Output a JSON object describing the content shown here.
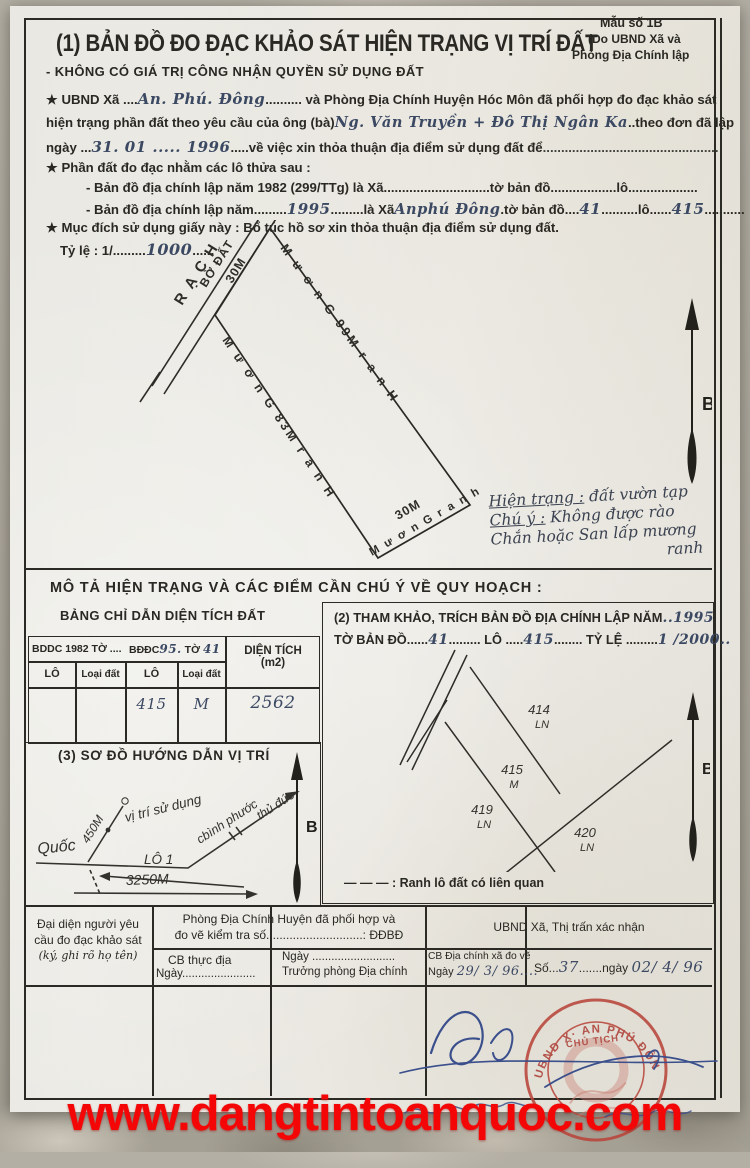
{
  "watermark": "www.dangtintoanquoc.com",
  "header": {
    "title": "(1) BẢN ĐỒ ĐO ĐẠC KHẢO SÁT HIỆN TRẠNG VỊ TRÍ ĐẤT",
    "subtitle": "- KHÔNG CÓ GIÁ TRỊ CÔNG NHẬN QUYỀN SỬ DỤNG ĐẤT",
    "form_note_1": "Mẫu số 1B",
    "form_note_2": "(Do UBND Xã và",
    "form_note_3": "Phòng Địa Chính lập"
  },
  "intro": {
    "line1_pre": "★  UBND Xã ....",
    "line1_hw": "An. Phú. Đông",
    "line1_post": ".......... và Phòng Địa Chính Huyện Hóc Môn đã phối hợp đo đạc khảo sát",
    "line2_pre": "hiện trạng phần đất theo yêu cầu của ông (bà)",
    "line2_hw": "Ng. Văn Truyền + Đô Thị Ngân Ka",
    "line2_post": "..theo đơn đã lập",
    "line3_pre": "ngày ...",
    "line3_hw": "31. 01 ..... 1996",
    "line3_post": ".....về việc xin thỏa thuận địa điểm sử dụng đất để",
    "line3_dots": "................................................",
    "line4": "★  Phần đất đo đạc nhằm các lô thửa sau :",
    "line5": "- Bản đồ địa chính lập năm 1982 (299/TTg) là Xã.............................tờ bản đồ..................lô...................",
    "line6_pre": "- Bản đồ địa chính lập năm.........",
    "line6_hw_year": "1995",
    "line6_d1": ".........là Xã",
    "line6_hw_commune": "Anphú Đông",
    "line6_d2": ".tờ bản đồ....",
    "line6_hw_sheet": "41",
    "line6_d3": "..........lô......",
    "line6_hw_lot": "415",
    "line6_d4": "...........",
    "line7": "★  Mục đích sử dụng giấy này : Bổ túc hồ sơ xin thỏa thuận địa điểm sử dụng đất.",
    "line8_pre": "Tỷ lệ : 1/.........",
    "line8_hw": "1000",
    "line8_post": "......"
  },
  "map1": {
    "canal_label_1": "R Ạ C H",
    "canal_label_2": "BỜ  ĐẤT",
    "edge_top": "30M",
    "edge_right": "M ư ơ n G     99M     r a n H",
    "edge_left": "M ư ơ n G    83M    r a n H",
    "edge_bottom_num": "30M",
    "edge_bottom_text": "M ư ơ n G   r a n h",
    "north_label": "B",
    "note_line1": "Hiện trạng :",
    "note_line1b": "đất vườn tạp",
    "note_line2": "Chú ý :",
    "note_line2b": "Không được rào",
    "note_line3": "Chắn hoặc San lấp mương",
    "note_line4": "ranh"
  },
  "describe_heading": "MÔ TẢ HIỆN TRẠNG VÀ CÁC ĐIỂM CẦN CHÚ Ý VỀ QUY HOẠCH :",
  "area_table": {
    "title": "BẢNG CHỈ DẪN DIỆN TÍCH ĐẤT",
    "h_1982": "BDDC 1982 TỜ ....",
    "h_95_pre": "BĐĐC",
    "h_95_hw": "95.",
    "h_95_mid": "TỜ",
    "h_95_hw2": "41",
    "h_dientich1": "DIỆN TÍCH",
    "h_dientich2": "(m2)",
    "h_lo1": "LÔ",
    "h_loaidat1": "Loại đất",
    "h_lo2": "LÔ",
    "h_loaidat2": "Loại đất",
    "row": {
      "lot": "415",
      "type": "M",
      "area": "2562"
    }
  },
  "section2": {
    "title_pre": "(2) THAM KHẢO, TRÍCH BẢN ĐỒ ĐỊA CHÍNH LẬP NĂM",
    "title_hw_year": "..1995",
    "t2a": "TỜ BẢN ĐỒ......",
    "hw_sheet": "41",
    "t2b": "......... LÔ .....",
    "hw_lot": "415",
    "t2c": "........ TỶ LỆ .........",
    "hw_scale": "1 /2000..",
    "p414": "414",
    "p414t": "LN",
    "p415": "415",
    "p415t": "M",
    "p419": "419",
    "p419t": "LN",
    "p420": "420",
    "p420t": "LN",
    "north_label": "B",
    "legend_dash": "—  —  —",
    "legend_text": ":  Ranh lô đất có liên quan"
  },
  "section3": {
    "title": "(3) SƠ ĐỒ HƯỚNG DẪN VỊ TRÍ",
    "quoc": "Quốc",
    "lo1": "LÔ 1",
    "dist": "3250M",
    "d450": "450M",
    "vitri": "vị trí sử dụng",
    "binhphuoc": "cbình phước",
    "thuduc": "thủ đức",
    "north_label": "B"
  },
  "footer": {
    "col1_line1": "Đại diện người yêu",
    "col1_line2": "cầu đo đạc khảo sát",
    "col1_line3": "(ký, ghi rõ họ tên)",
    "col2_header1": "Phòng Địa Chính Huyện đã phối hợp và",
    "col2_header2": "đo vẽ kiểm tra số.............................: ĐĐBĐ",
    "cellA_1": "CB thực địa",
    "cellA_2": "Ngày.......................",
    "cellB_1": "Ngày ..........................",
    "cellB_2": "Trưởng phòng Địa chính",
    "col3_header": "UBND Xã, Thị trấn xác nhận",
    "cellC_1": "CB Địa chính xã đo vẽ",
    "cellC_2_pre": "Ngày",
    "cellC_2_hw": "29/ 3/ 96....",
    "cellD_pre": "Số...",
    "cellD_hw_so": "37",
    "cellD_mid": ".......ngày",
    "cellD_hw_date": "02/ 4/ 96",
    "stamp_arc": "UBND X· AN PHÚ ĐÔNG",
    "stamp_mid": "CHỦ TỊCH"
  }
}
